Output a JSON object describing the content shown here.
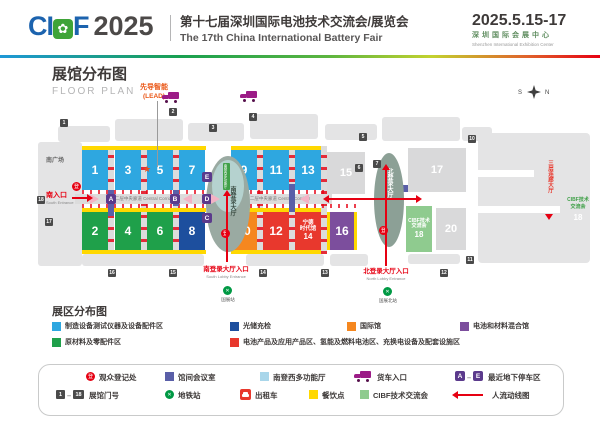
{
  "colors": {
    "light_blue": "#2EA7E0",
    "dark_blue": "#1D4F9E",
    "green": "#1FA04A",
    "orange": "#F5871F",
    "red": "#E8382D",
    "purple": "#7C4E9D",
    "light_green": "#8FCB8F",
    "yellow": "#FFD800",
    "accent_red": "#E60012",
    "parking_purple": "#5B3A8C",
    "meeting_purple": "#5A5FA8",
    "multi_blue": "#A9D6EA",
    "truck_purple": "#9C1C87",
    "metro_green": "#009944"
  },
  "header": {
    "logo_ci": "CI",
    "logo_b_icon": "✿",
    "logo_f": "F",
    "logo_year": "2025",
    "title_cn": "第十七届深圳国际电池技术交流会/展览会",
    "title_en": "The 17th China International Battery Fair",
    "date": "2025.5.15-17",
    "venue_cn": "深圳国际会展中心",
    "venue_en": "Shenzhen International Exhibition Center"
  },
  "map": {
    "title_cn": "展馆分布图",
    "title_en": "FLOOR PLAN",
    "compass_s": "S",
    "compass_n": "N",
    "lead_line1": "先导智能",
    "lead_line2": "(LEAD)",
    "lead_star": "★",
    "south_plaza": "南广场",
    "south_entrance_cn": "南入口",
    "south_entrance_en": "South Entrance",
    "corridor": "二层中央廊道 Central Corridor",
    "south_lobby": "南登录大厅",
    "north_lobby": "北登录大厅",
    "multi_hall": "南登西多功能厅",
    "south_lobby_entrance_cn": "南登录大厅入口",
    "south_lobby_entrance_en": "South Lobby Entrance",
    "north_lobby_entrance_cn": "北登录大厅入口",
    "north_lobby_entrance_en": "North Lobby Entrance",
    "metro_south": "国展站",
    "metro_north": "国展北站",
    "bridge_hall": "三层连廊大厅",
    "right_cibf_l1": "CIBF技术",
    "right_cibf_l2": "交流会",
    "right_cibf_num": "18",
    "reg": "登",
    "metro_glyph": "✕",
    "halls": {
      "h1": "1",
      "h2": "2",
      "h3": "3",
      "h4": "4",
      "h5": "5",
      "h6": "6",
      "h7": "7",
      "h8": "8",
      "h9": "9",
      "h10": "10",
      "h11": "11",
      "h12": "12",
      "h13": "13",
      "h15": "15",
      "h16": "16",
      "h17": "17",
      "h20": "20",
      "h14": [
        "宁德",
        "时代馆",
        "14"
      ],
      "h18": [
        "CIBF技术",
        "交流会",
        "18"
      ]
    },
    "gates": {
      "g1": "1",
      "g2": "2",
      "g3": "3",
      "g4": "4",
      "g5": "5",
      "g6": "6",
      "g7": "7",
      "g10": "10",
      "g11": "11",
      "g12": "12",
      "g13": "13",
      "g14": "14",
      "g15": "15",
      "g16": "16",
      "g17": "17",
      "g18": "18"
    },
    "parking": {
      "a": "A",
      "b": "B",
      "c": "C",
      "d": "D",
      "e": "E"
    }
  },
  "zones": {
    "title": "展区分布图",
    "items": [
      {
        "label": "制造设备测试仪器及设备配件区"
      },
      {
        "label": "光储充检"
      },
      {
        "label": "国际馆"
      },
      {
        "label": "电池和材料混合馆"
      },
      {
        "label": "原材料及零配件区"
      },
      {
        "label": "电池产品及应用产品区、氢能及燃料电池区、充换电设备及配套设施区"
      }
    ]
  },
  "legend": {
    "reg": "观众登记处",
    "meeting": "馆间会议室",
    "multi": "南登西多功能厅",
    "truck": "货车入口",
    "parking_a": "A",
    "parking_e": "E",
    "parking_label": "最近地下停车区",
    "gate_1": "1",
    "gate_18": "18",
    "gate_label": "展馆门号",
    "metro": "地铁站",
    "taxi": "出租车",
    "food": "餐饮点",
    "cibf": "CIBF技术交流会",
    "flow": "人流动线图",
    "dash": "–"
  }
}
